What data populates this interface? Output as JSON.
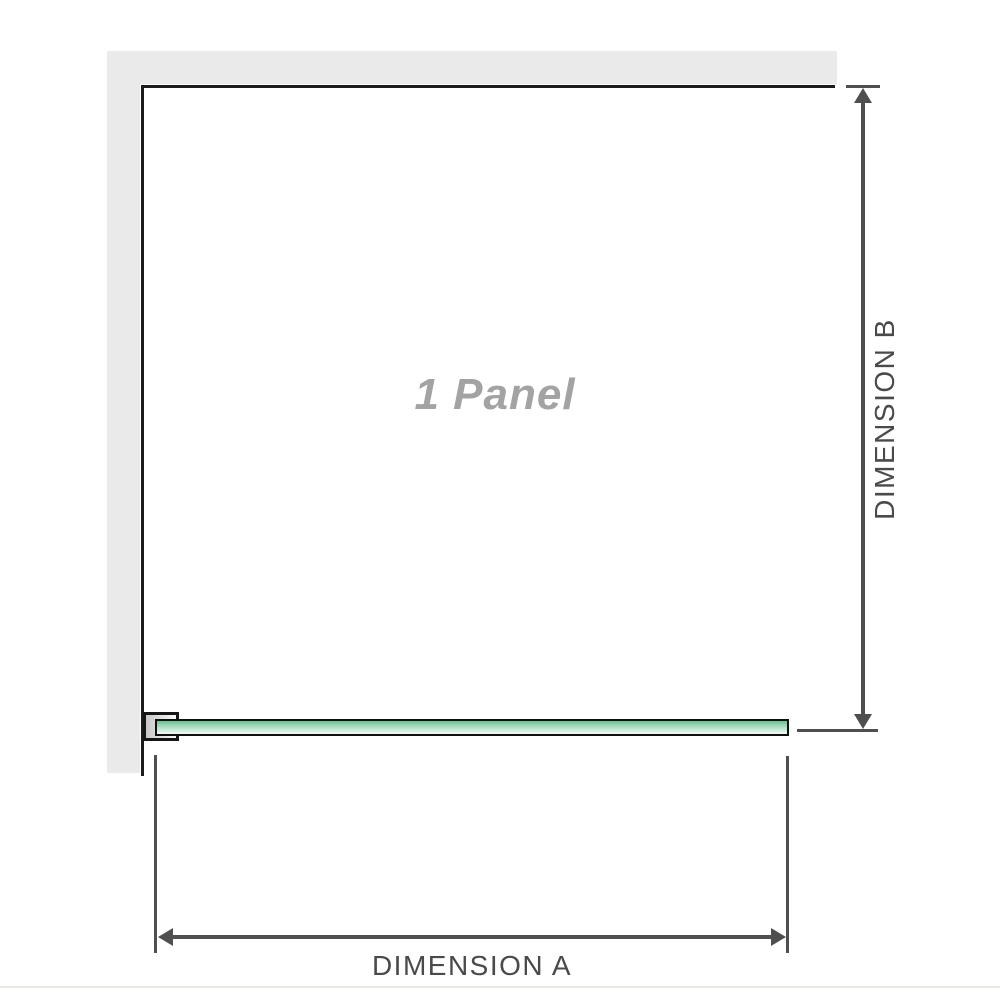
{
  "diagram": {
    "title": "Shower screen single panel dimension diagram",
    "panel_label": "1 Panel",
    "dimension_a": {
      "label": "DIMENSION A",
      "orientation": "horizontal"
    },
    "dimension_b": {
      "label": "DIMENSION B",
      "orientation": "vertical"
    },
    "colors": {
      "background": "#ffffff",
      "wall_fill": "#eaeaea",
      "panel_outline": "#1c1c1c",
      "dimension_lines": "#4f4f4f",
      "dimension_text": "#4a4a4a",
      "panel_label_text": "#a3a3a3",
      "glass_green_dark": "#6dbd92",
      "glass_green_light": "#f0faf5",
      "bracket_fill_dark": "#c8c8c8",
      "bracket_fill_light": "#fafafa",
      "baseline_rule": "#eae7e0"
    }
  }
}
